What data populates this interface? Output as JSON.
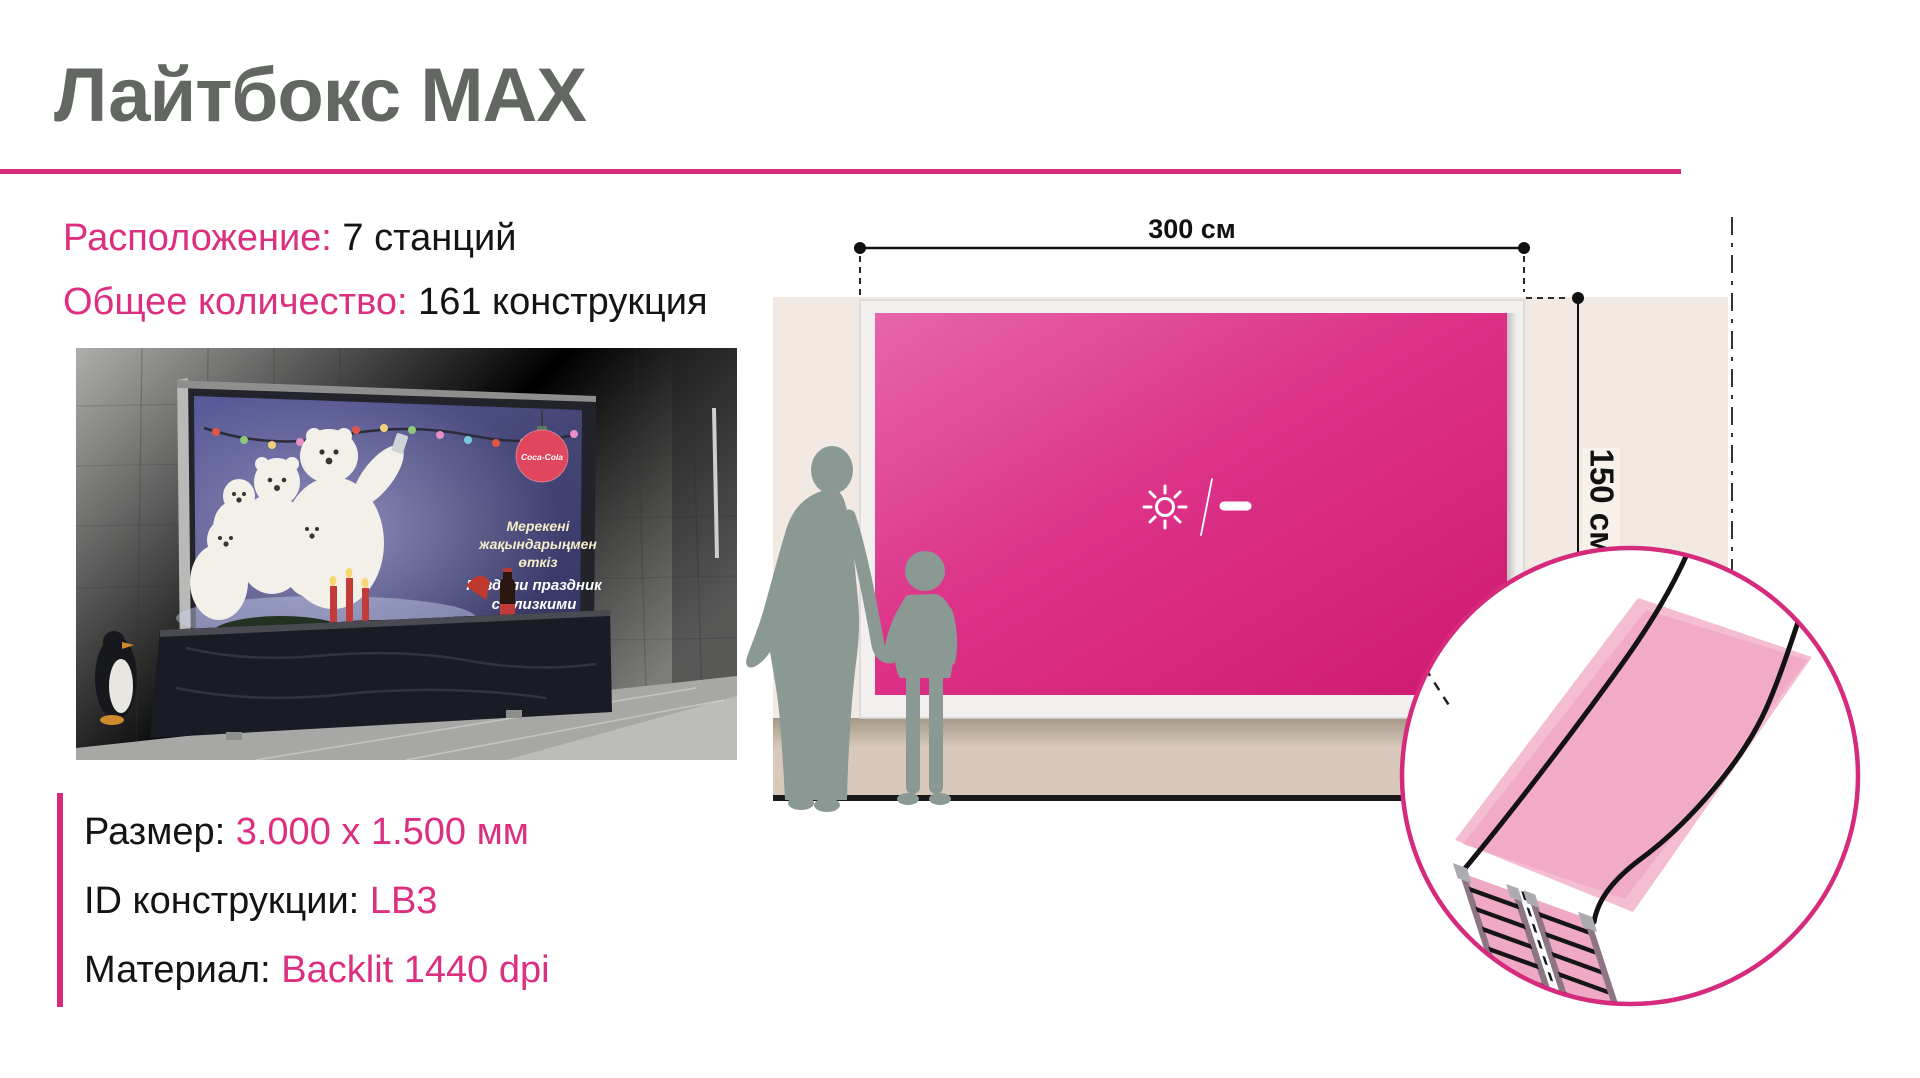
{
  "theme": {
    "accent": "#d62a7c",
    "text_pink": "#dc2f80",
    "title_color": "#626861",
    "wall_beige": "#f2e9e3",
    "screen_pink_light": "#e765ab",
    "screen_pink_dark": "#ce1970",
    "silhouette_gray": "#8b9994"
  },
  "header": {
    "title": "Лайтбокс MAX"
  },
  "stats": [
    {
      "label": "Расположение:",
      "value": "7 станций"
    },
    {
      "label": "Общее количество:",
      "value": "161 конструкция"
    }
  ],
  "specs": [
    {
      "label": "Размер:",
      "value": "3.000 х 1.500 мм"
    },
    {
      "label": "ID конструкции:",
      "value": "LB3"
    },
    {
      "label": "Материал:",
      "value": "Backlit 1440 dpi"
    }
  ],
  "diagram": {
    "width_label": "300 см",
    "height_label": "150 см"
  },
  "photo": {
    "brand": "Coca-Cola",
    "ad_lines": [
      "Мерекені",
      "жақындарыңмен",
      "өткіз",
      "Раздели праздник",
      "с близкими"
    ]
  }
}
